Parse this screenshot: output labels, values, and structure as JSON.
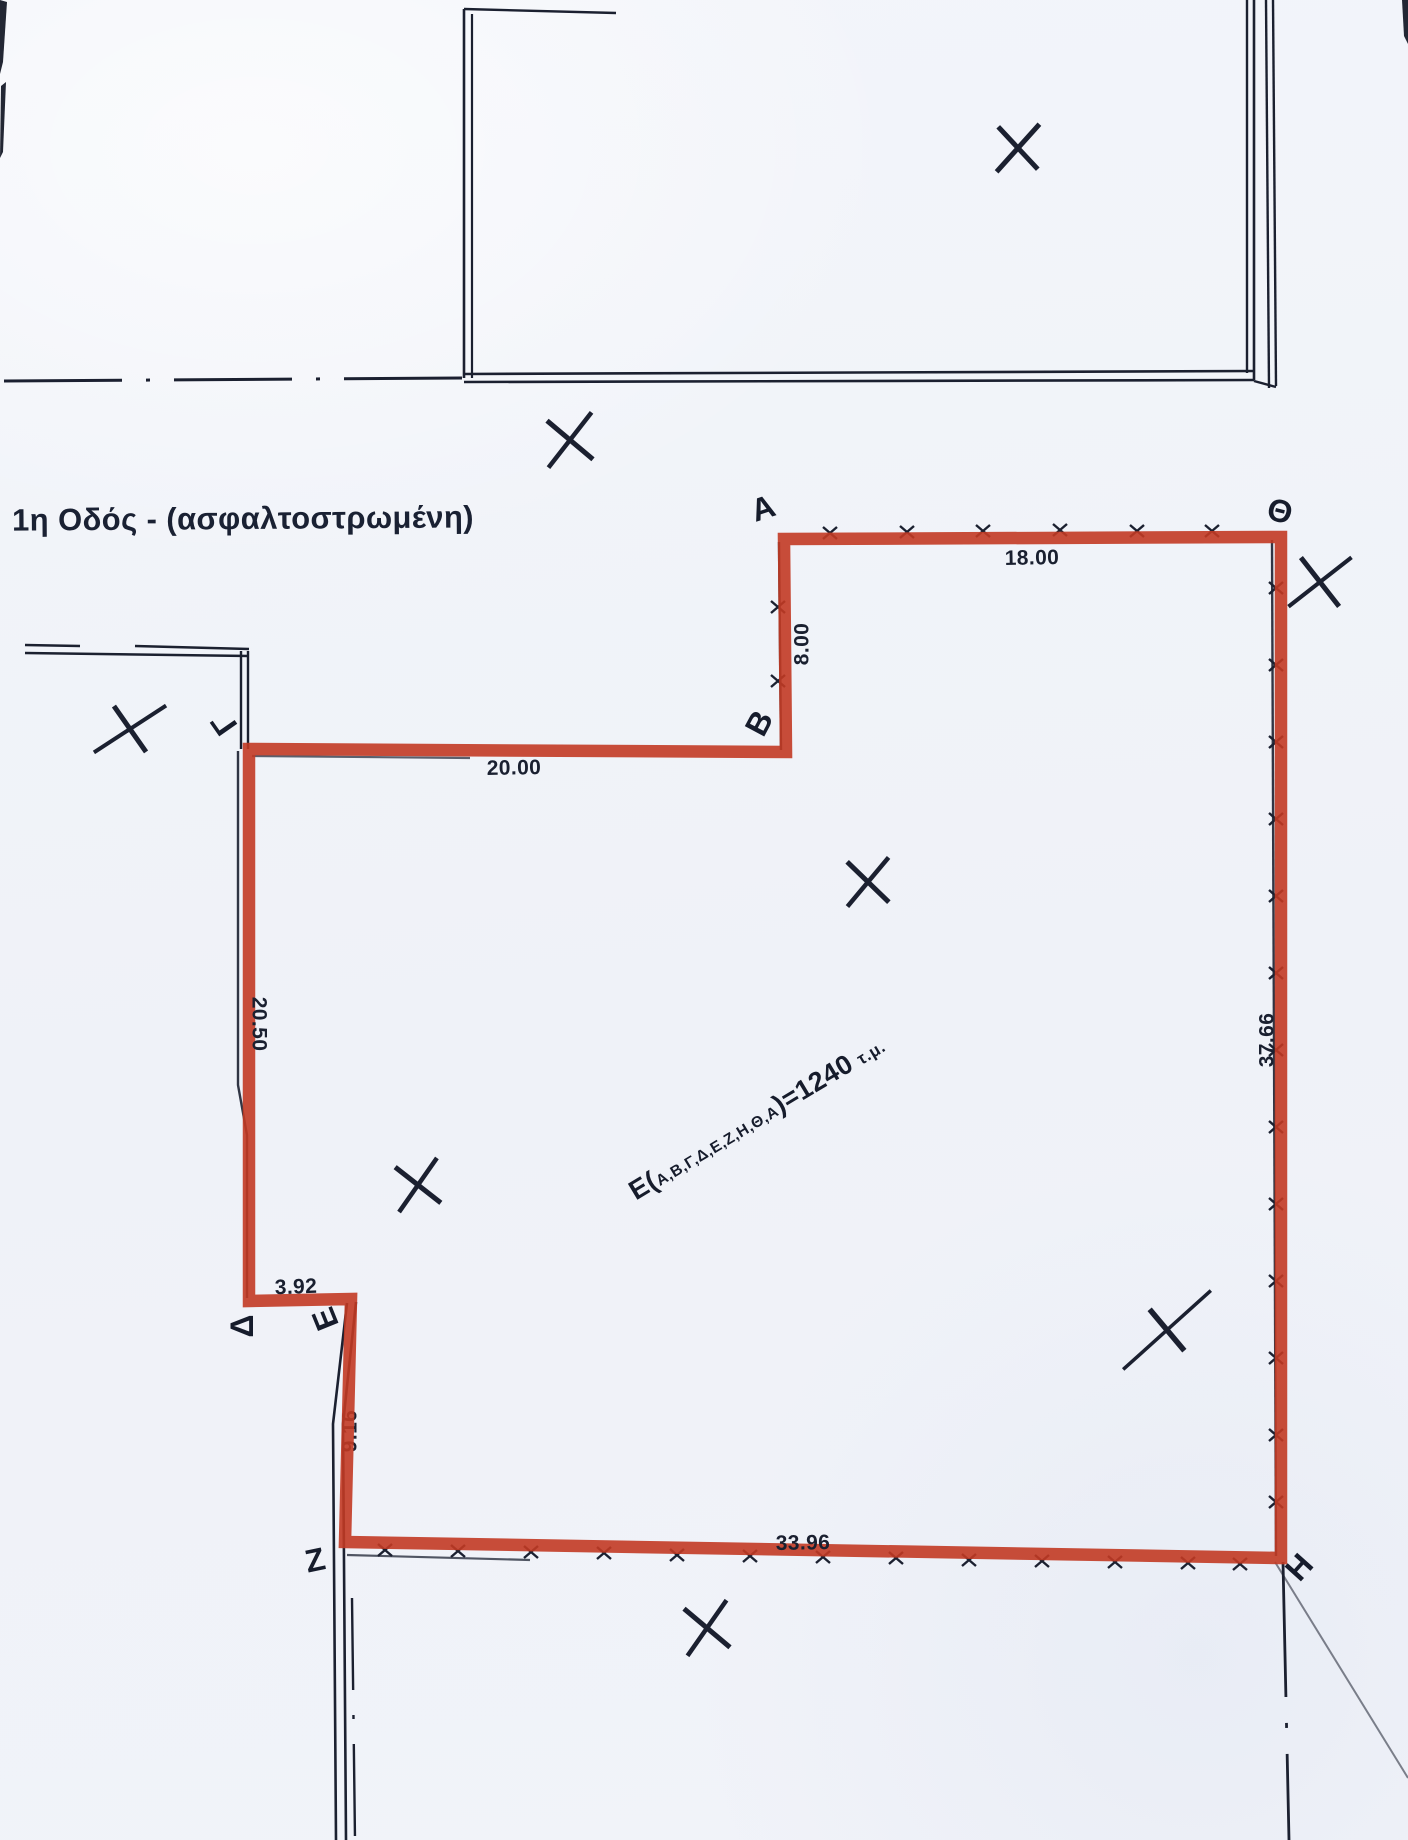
{
  "street_label": "1η Οδός - (ασφαλτοστρωμένη)",
  "area_label": {
    "prefix": "Ε(",
    "vertex_list": "Α,Β,Γ,Δ,Ε,Ζ,Η,Θ,Α",
    "result": ")=1240",
    "units": "τ.μ."
  },
  "colors": {
    "parcel_outline": "#c23a23",
    "ink": "#1b2030",
    "paper": "#f2f4f9"
  },
  "vertices": [
    {
      "label": "Α",
      "x": 763,
      "y": 508,
      "rot": -18
    },
    {
      "label": "Β",
      "x": 759,
      "y": 723,
      "rot": -62
    },
    {
      "label": "Γ",
      "x": 224,
      "y": 724,
      "rot": -125
    },
    {
      "label": "Δ",
      "x": 242,
      "y": 1326,
      "rot": -90
    },
    {
      "label": "Ε",
      "x": 325,
      "y": 1319,
      "rot": -112
    },
    {
      "label": "Ζ",
      "x": 315,
      "y": 1560,
      "rot": -12
    },
    {
      "label": "Η",
      "x": 1299,
      "y": 1567,
      "rot": -48
    },
    {
      "label": "Θ",
      "x": 1280,
      "y": 511,
      "rot": 14
    }
  ],
  "dimensions": [
    {
      "text": "18.00",
      "x": 1032,
      "y": 558,
      "rot": -1,
      "under": false
    },
    {
      "text": "8.00",
      "x": 802,
      "y": 644,
      "rot": -90,
      "under": false
    },
    {
      "text": "20.00",
      "x": 514,
      "y": 768,
      "rot": -1,
      "under": false
    },
    {
      "text": "20.50",
      "x": 259,
      "y": 1024,
      "rot": 90,
      "under": false
    },
    {
      "text": "3.92",
      "x": 296,
      "y": 1287,
      "rot": -2,
      "under": false
    },
    {
      "text": "9.16",
      "x": 350,
      "y": 1431,
      "rot": -90,
      "under": true
    },
    {
      "text": "33.96",
      "x": 803,
      "y": 1543,
      "rot": -1,
      "under": false
    },
    {
      "text": "37.66",
      "x": 1267,
      "y": 1040,
      "rot": -90,
      "under": false
    }
  ],
  "geometry": {
    "parcel_path": "M 784 539 L 786 752 L 249 749 L 249 1301 L 351 1299 L 345 1542 L 1281 1558 L 1281 537 Z",
    "parcel_stroke_width": 12.5,
    "boundary_lines": [
      {
        "d": "M 464 378 L 464 9",
        "w": 2.6
      },
      {
        "d": "M 472 378 L 472 14",
        "w": 2.2
      },
      {
        "d": "M 464 9 L 616 13",
        "w": 2.4
      },
      {
        "d": "M 464 374 L 1254 371",
        "w": 2.6
      },
      {
        "d": "M 464 382 L 1254 380",
        "w": 2.6
      },
      {
        "d": "M 1247 0 L 1247 373",
        "w": 2.4
      },
      {
        "d": "M 1254 0 L 1254 380",
        "w": 2.6
      },
      {
        "d": "M 1266 0 L 1269 388",
        "w": 2.4
      },
      {
        "d": "M 1273 0 L 1276 386",
        "w": 2.4
      },
      {
        "d": "M 1254 381 L 1276 387",
        "w": 2.4
      },
      {
        "d": "M 25 645 L 80 646",
        "w": 2.4
      },
      {
        "d": "M 135 646 L 249 649",
        "w": 2.4
      },
      {
        "d": "M 25 653 L 249 656",
        "w": 2.6
      },
      {
        "d": "M 241 651 L 241 749",
        "w": 2.4
      },
      {
        "d": "M 248 651 L 248 749",
        "w": 2.4
      }
    ],
    "dashdot_lines": [
      {
        "d": "M 4 381 L 463 378",
        "w": 3,
        "dash": "118 24 4 24"
      },
      {
        "d": "M 1283 1562 L 1289 1840",
        "w": 2.8,
        "dash": "135 26 5 26"
      },
      {
        "d": "M 352 1598 L 355 1840",
        "w": 2.4,
        "dash": "92 25 4 25"
      }
    ],
    "survey_lines": [
      {
        "d": "M 779 542 L 781 750",
        "w": 2.4,
        "o": 0.9
      },
      {
        "d": "M 252 756 L 470 758",
        "w": 2.2,
        "o": 0.7
      },
      {
        "d": "M 238 751 L 238 1085 L 247 1135 L 247 1298",
        "w": 2.4,
        "o": 0.9
      },
      {
        "d": "M 1272 540 L 1276 1556",
        "w": 2.4,
        "o": 0.9
      },
      {
        "d": "M 347 1303 L 333 1424 L 336 1840",
        "w": 2.6,
        "o": 1
      },
      {
        "d": "M 356 1302 L 343 1424 L 346 1840",
        "w": 2.6,
        "o": 1
      },
      {
        "d": "M 347 1555 L 530 1560",
        "w": 2.2,
        "o": 0.75
      },
      {
        "d": "M 1275 1562 L 1408 1778",
        "w": 2,
        "o": 0.55
      }
    ],
    "ticks": [
      [
        830,
        533
      ],
      [
        907,
        532
      ],
      [
        983,
        531
      ],
      [
        1060,
        530
      ],
      [
        1137,
        531
      ],
      [
        1212,
        531
      ],
      [
        778,
        607
      ],
      [
        778,
        681
      ],
      [
        1276,
        588
      ],
      [
        1276,
        665
      ],
      [
        1276,
        742
      ],
      [
        1276,
        819
      ],
      [
        1276,
        896
      ],
      [
        1276,
        973
      ],
      [
        1276,
        1050
      ],
      [
        1276,
        1127
      ],
      [
        1276,
        1204
      ],
      [
        1276,
        1281
      ],
      [
        1276,
        1358
      ],
      [
        1276,
        1435
      ],
      [
        1276,
        1502
      ],
      [
        385,
        1550
      ],
      [
        458,
        1551
      ],
      [
        531,
        1552
      ],
      [
        604,
        1553
      ],
      [
        677,
        1555
      ],
      [
        750,
        1556
      ],
      [
        823,
        1557
      ],
      [
        896,
        1558
      ],
      [
        969,
        1560
      ],
      [
        1042,
        1561
      ],
      [
        1115,
        1562
      ],
      [
        1188,
        1563
      ],
      [
        1240,
        1564
      ]
    ],
    "xmarks": [
      {
        "x": 1018,
        "y": 148,
        "a1": -48,
        "l1": 64,
        "w1": 5,
        "a2": 47,
        "l2": 58,
        "w2": 5
      },
      {
        "x": 570,
        "y": 440,
        "a1": -52,
        "l1": 70,
        "w1": 4.5,
        "a2": 40,
        "l2": 60,
        "w2": 5
      },
      {
        "x": 1320,
        "y": 582,
        "a1": -38,
        "l1": 80,
        "w1": 4,
        "a2": 52,
        "l2": 62,
        "w2": 5
      },
      {
        "x": 130,
        "y": 729,
        "a1": -33,
        "l1": 86,
        "w1": 4,
        "a2": 55,
        "l2": 56,
        "w2": 5
      },
      {
        "x": 868,
        "y": 882,
        "a1": -50,
        "l1": 64,
        "w1": 4.5,
        "a2": 44,
        "l2": 58,
        "w2": 5
      },
      {
        "x": 418,
        "y": 1185,
        "a1": -55,
        "l1": 66,
        "w1": 4.5,
        "a2": 38,
        "l2": 58,
        "w2": 5
      },
      {
        "x": 1167,
        "y": 1330,
        "a1": -42,
        "l1": 118,
        "w1": 3.5,
        "a2": 50,
        "l2": 54,
        "w2": 5.5
      },
      {
        "x": 707,
        "y": 1628,
        "a1": -55,
        "l1": 68,
        "w1": 4.5,
        "a2": 40,
        "l2": 60,
        "w2": 5
      }
    ],
    "artifacts": [
      "M 0 0 L 7 2 L 3 62 L 0 74 Z",
      "M 1 86 L 6 82 L 3 152 L 0 158 Z",
      "M 1402 0 L 1408 0 L 1408 44 L 1404 36 Z"
    ]
  }
}
